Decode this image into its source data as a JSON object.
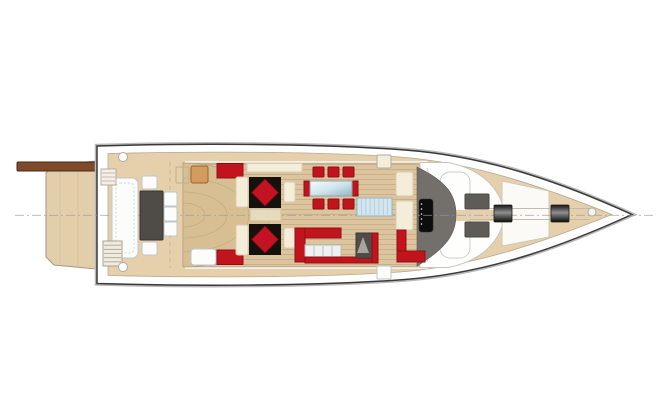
{
  "meta": {
    "title": "motor-yacht-main-deck-plan",
    "view": "top-view"
  },
  "colors": {
    "hull_outline": "#3a3a3a",
    "rubrail": "#b9b9b9",
    "hull_white": "#ffffff",
    "deck_tan": "#e5d0ab",
    "deck_edge": "#b4ab94",
    "wood": "#dcc49e",
    "wood_line": "#c3a87e",
    "fan_wood": "#d8bf93",
    "platform_tan": "#e3ceaa",
    "passerelle_brown": "#7e4a2a",
    "passerelle_edge": "#46281a",
    "red": "#c2141d",
    "red_dark": "#8e0f16",
    "diamond_red": "#c31322",
    "rug_black": "#15120e",
    "cream": "#f3edda",
    "cream_stroke": "#d8cdb0",
    "white_f": "#fcfcfa",
    "white_stroke": "#bfc6c9",
    "dark_table": "#4f4c48",
    "sunpad_gray": "#5f5c58",
    "helm_gray": "#73706c",
    "stairs_blue": "#d3e6ee",
    "stairs_blue_line": "#a9cbd9",
    "orange_chair": "#d49a60",
    "appliance_white": "#eff1f1",
    "appliance_line": "#aeb4b7",
    "centerline_gray": "#9a9a9a"
  },
  "furniture": [
    {
      "name": "transom-bench",
      "type": "rect",
      "x": 112,
      "y": 178,
      "w": 26,
      "h": 80,
      "rx": 6,
      "fill": "white_f",
      "stroke": "white_stroke"
    },
    {
      "name": "transom-bench-cushion-line",
      "type": "orect",
      "x": 116,
      "y": 183,
      "w": 18,
      "h": 70,
      "rx": 4,
      "stroke": "#bedce0",
      "dash": "2 2"
    },
    {
      "name": "cockpit-table",
      "type": "rect",
      "x": 140,
      "y": 191,
      "w": 23,
      "h": 49,
      "rx": 1,
      "fill": "dark_table",
      "stroke": "#35332d"
    },
    {
      "name": "cockpit-chair-head-aft",
      "type": "rect",
      "x": 142,
      "y": 176,
      "w": 15,
      "h": 13,
      "rx": 2,
      "fill": "white_f",
      "stroke": "white_stroke"
    },
    {
      "name": "cockpit-chair-head-fwd",
      "type": "rect",
      "x": 142,
      "y": 242,
      "w": 15,
      "h": 13,
      "rx": 2,
      "fill": "white_f",
      "stroke": "white_stroke"
    },
    {
      "name": "cockpit-chair-side-1",
      "type": "rect",
      "x": 164,
      "y": 192,
      "w": 13,
      "h": 14,
      "rx": 2,
      "fill": "white_f",
      "stroke": "white_stroke"
    },
    {
      "name": "cockpit-chair-side-2",
      "type": "rect",
      "x": 164,
      "y": 207,
      "w": 13,
      "h": 14,
      "rx": 2,
      "fill": "white_f",
      "stroke": "white_stroke"
    },
    {
      "name": "cockpit-chair-side-3",
      "type": "rect",
      "x": 164,
      "y": 222,
      "w": 13,
      "h": 14,
      "rx": 2,
      "fill": "white_f",
      "stroke": "white_stroke"
    },
    {
      "name": "wicker-chair",
      "type": "rect",
      "x": 191,
      "y": 166,
      "w": 17,
      "h": 17,
      "rx": 2,
      "fill": "orange_chair",
      "stroke": "#9a622e"
    },
    {
      "name": "wicker-chair-outline",
      "type": "orect",
      "x": 176,
      "y": 167,
      "w": 13,
      "h": 16,
      "rx": 1,
      "stroke": "#c0b08d"
    },
    {
      "name": "boarding-stairs",
      "type": "hstairs",
      "x": 103,
      "y": 241,
      "w": 19,
      "h": 25,
      "lines": 5,
      "fill": "#f0ebdd",
      "stroke": "#a9a293",
      "lineColor": "#a9a293"
    },
    {
      "name": "boarding-gate-steps",
      "type": "hstairs",
      "x": 101,
      "y": 169,
      "w": 15,
      "h": 16,
      "lines": 3,
      "fill": "#f4f0e6",
      "stroke": "#b5ae9e",
      "lineColor": "#b5ae9e"
    },
    {
      "name": "deck-fitting-aft-port",
      "type": "circle",
      "cx": 123,
      "cy": 157,
      "r": 4.5,
      "fill": "#ffffff",
      "stroke": "#aeaea6"
    },
    {
      "name": "deck-fitting-aft-starboard",
      "type": "circle",
      "cx": 123,
      "cy": 267,
      "r": 4.5,
      "fill": "#ffffff",
      "stroke": "#aeaea6"
    },
    {
      "name": "salon-cabinet-port",
      "type": "rect",
      "x": 247,
      "y": 163.5,
      "w": 55,
      "h": 8.5,
      "fill": "cream",
      "stroke": "cream_stroke"
    },
    {
      "name": "red-sideboard-port",
      "type": "rect",
      "x": 217,
      "y": 163.5,
      "w": 26,
      "h": 14.5,
      "fill": "red",
      "stroke": "red_dark"
    },
    {
      "name": "red-sideboard-starboard",
      "type": "rect",
      "x": 217,
      "y": 250,
      "w": 26,
      "h": 14.5,
      "fill": "red",
      "stroke": "red_dark"
    },
    {
      "name": "salon-bench-aft-starboard",
      "type": "rect",
      "x": 191,
      "y": 249,
      "w": 25,
      "h": 16,
      "rx": 3,
      "fill": "white_f",
      "stroke": "white_stroke"
    },
    {
      "name": "lounge-sofa-port",
      "type": "rect",
      "x": 236,
      "y": 177,
      "w": 12,
      "h": 30,
      "rx": 2,
      "fill": "cream",
      "stroke": "cream_stroke"
    },
    {
      "name": "lounge-sofa-starboard",
      "type": "rect",
      "x": 236,
      "y": 225,
      "w": 12,
      "h": 30,
      "rx": 2,
      "fill": "cream",
      "stroke": "cream_stroke"
    },
    {
      "name": "lounge-rug-port",
      "type": "rect",
      "x": 249,
      "y": 177,
      "w": 32,
      "h": 31,
      "fill": "rug_black"
    },
    {
      "name": "lounge-rug-starboard",
      "type": "rect",
      "x": 249,
      "y": 224,
      "w": 32,
      "h": 31,
      "fill": "rug_black"
    },
    {
      "name": "lounge-table-diamond-port",
      "type": "diamond",
      "cx": 265,
      "cy": 192.5,
      "r": 13.5,
      "fill": "diamond_red",
      "stroke": "#6e0a10"
    },
    {
      "name": "lounge-table-diamond-starboard",
      "type": "diamond",
      "cx": 265,
      "cy": 239.5,
      "r": 13.5,
      "fill": "diamond_red",
      "stroke": "#6e0a10"
    },
    {
      "name": "lounge-side-table-port",
      "type": "rect",
      "x": 284,
      "y": 182,
      "w": 11,
      "h": 20,
      "rx": 2,
      "fill": "cream",
      "stroke": "cream_stroke"
    },
    {
      "name": "lounge-side-table-starboard",
      "type": "rect",
      "x": 284,
      "y": 228,
      "w": 11,
      "h": 20,
      "rx": 2,
      "fill": "cream",
      "stroke": "cream_stroke"
    },
    {
      "name": "lounge-center-cabinet",
      "type": "rect",
      "x": 250,
      "y": 209,
      "w": 31,
      "h": 12,
      "fill": "#e7dbbd",
      "stroke": "#cfc19e"
    },
    {
      "name": "dining-chair-port-1",
      "type": "rect",
      "x": 313,
      "y": 167,
      "w": 11,
      "h": 10,
      "rx": 1,
      "fill": "red",
      "stroke": "red_dark"
    },
    {
      "name": "dining-chair-port-2",
      "type": "rect",
      "x": 328,
      "y": 167,
      "w": 11,
      "h": 10,
      "rx": 1,
      "fill": "red",
      "stroke": "red_dark"
    },
    {
      "name": "dining-chair-port-3",
      "type": "rect",
      "x": 343,
      "y": 167,
      "w": 11,
      "h": 10,
      "rx": 1,
      "fill": "red",
      "stroke": "red_dark"
    },
    {
      "name": "dining-chair-stbd-1",
      "type": "rect",
      "x": 313,
      "y": 199,
      "w": 11,
      "h": 10,
      "rx": 1,
      "fill": "red",
      "stroke": "red_dark"
    },
    {
      "name": "dining-chair-stbd-2",
      "type": "rect",
      "x": 328,
      "y": 199,
      "w": 11,
      "h": 10,
      "rx": 1,
      "fill": "red",
      "stroke": "red_dark"
    },
    {
      "name": "dining-chair-stbd-3",
      "type": "rect",
      "x": 343,
      "y": 199,
      "w": 11,
      "h": 10,
      "rx": 1,
      "fill": "red",
      "stroke": "red_dark"
    },
    {
      "name": "dining-table-end-aft",
      "type": "rect",
      "x": 304,
      "y": 181,
      "w": 6,
      "h": 15,
      "fill": "red",
      "stroke": "red_dark"
    },
    {
      "name": "dining-table-end-fwd",
      "type": "rect",
      "x": 352,
      "y": 181,
      "w": 6,
      "h": 15,
      "fill": "red",
      "stroke": "red_dark"
    },
    {
      "name": "dining-table-glass",
      "type": "glass",
      "x": 310,
      "y": 181,
      "w": 42,
      "h": 15
    },
    {
      "name": "galley-counter-top",
      "type": "rect",
      "x": 300,
      "y": 228,
      "w": 41,
      "h": 10,
      "fill": "red",
      "stroke": "red_dark"
    },
    {
      "name": "galley-counter-left",
      "type": "rect",
      "x": 295,
      "y": 228,
      "w": 10,
      "h": 34,
      "fill": "red",
      "stroke": "red_dark"
    },
    {
      "name": "galley-appliances",
      "type": "vstripes",
      "x": 305,
      "y": 245,
      "w": 36,
      "h": 12,
      "lines": 3,
      "fill": "appliance_white",
      "stroke": "#b7bcbf",
      "lineColor": "appliance_line"
    },
    {
      "name": "galley-counter-front",
      "type": "rect",
      "x": 305,
      "y": 257,
      "w": 73,
      "h": 6,
      "fill": "red",
      "stroke": "red_dark"
    },
    {
      "name": "lower-deck-stair-island",
      "type": "rect",
      "x": 356,
      "y": 233,
      "w": 16,
      "h": 25,
      "fill": "#504d49",
      "stroke": "#3b3935"
    },
    {
      "name": "lower-deck-stair-wedge",
      "type": "poly",
      "points": "363,237 369,253 357,253",
      "fill": "#a8a5a1"
    },
    {
      "name": "galley-counter-right",
      "type": "rect",
      "x": 372,
      "y": 233,
      "w": 6,
      "h": 30,
      "fill": "red",
      "stroke": "red_dark"
    },
    {
      "name": "companionway-glass-stairs",
      "type": "vstripes",
      "x": 357,
      "y": 198,
      "w": 35,
      "h": 18,
      "lines": 7,
      "fill": "stairs_blue",
      "stroke": "#8fb4c4",
      "lineColor": "stairs_blue_line"
    },
    {
      "name": "helm-seat-aft",
      "type": "rect",
      "x": 396,
      "y": 172,
      "w": 17,
      "h": 24,
      "rx": 2,
      "fill": "cream",
      "stroke": "cream_stroke"
    },
    {
      "name": "helm-seat-fwd",
      "type": "rect",
      "x": 396,
      "y": 201,
      "w": 17,
      "h": 29,
      "rx": 2,
      "fill": "cream",
      "stroke": "cream_stroke"
    },
    {
      "name": "helm-bench-side",
      "type": "rect",
      "x": 397,
      "y": 230,
      "w": 9,
      "h": 21,
      "fill": "red",
      "stroke": "red_dark"
    },
    {
      "name": "helm-bench",
      "type": "rect",
      "x": 397,
      "y": 251,
      "w": 28,
      "h": 11,
      "fill": "red",
      "stroke": "red_dark"
    },
    {
      "name": "deck-box-port",
      "type": "rect",
      "x": 377,
      "y": 155,
      "w": 14,
      "h": 13,
      "rx": 1,
      "fill": "cream",
      "stroke": "#b3ab95"
    },
    {
      "name": "deck-box-starboard",
      "type": "rect",
      "x": 377,
      "y": 266,
      "w": 14,
      "h": 13,
      "rx": 1,
      "fill": "white_f",
      "stroke": "white_stroke"
    },
    {
      "name": "sunpad-port",
      "type": "rect",
      "x": 465,
      "y": 194,
      "w": 24,
      "h": 15,
      "rx": 1,
      "fill": "sunpad_gray",
      "stroke": "#4b4845"
    },
    {
      "name": "sunpad-starboard",
      "type": "rect",
      "x": 465,
      "y": 222,
      "w": 24,
      "h": 15,
      "rx": 1,
      "fill": "sunpad_gray",
      "stroke": "#4b4845"
    },
    {
      "name": "bow-winch-aft",
      "type": "winch",
      "x": 494,
      "y": 205,
      "w": 18,
      "h": 17
    },
    {
      "name": "bow-winch-fwd",
      "type": "winch",
      "x": 551,
      "y": 205,
      "w": 18,
      "h": 17
    },
    {
      "name": "bow-fitting",
      "type": "circle",
      "cx": 592,
      "cy": 212,
      "r": 4,
      "fill": "#f6f4ef",
      "stroke": "#b2aca0"
    }
  ]
}
